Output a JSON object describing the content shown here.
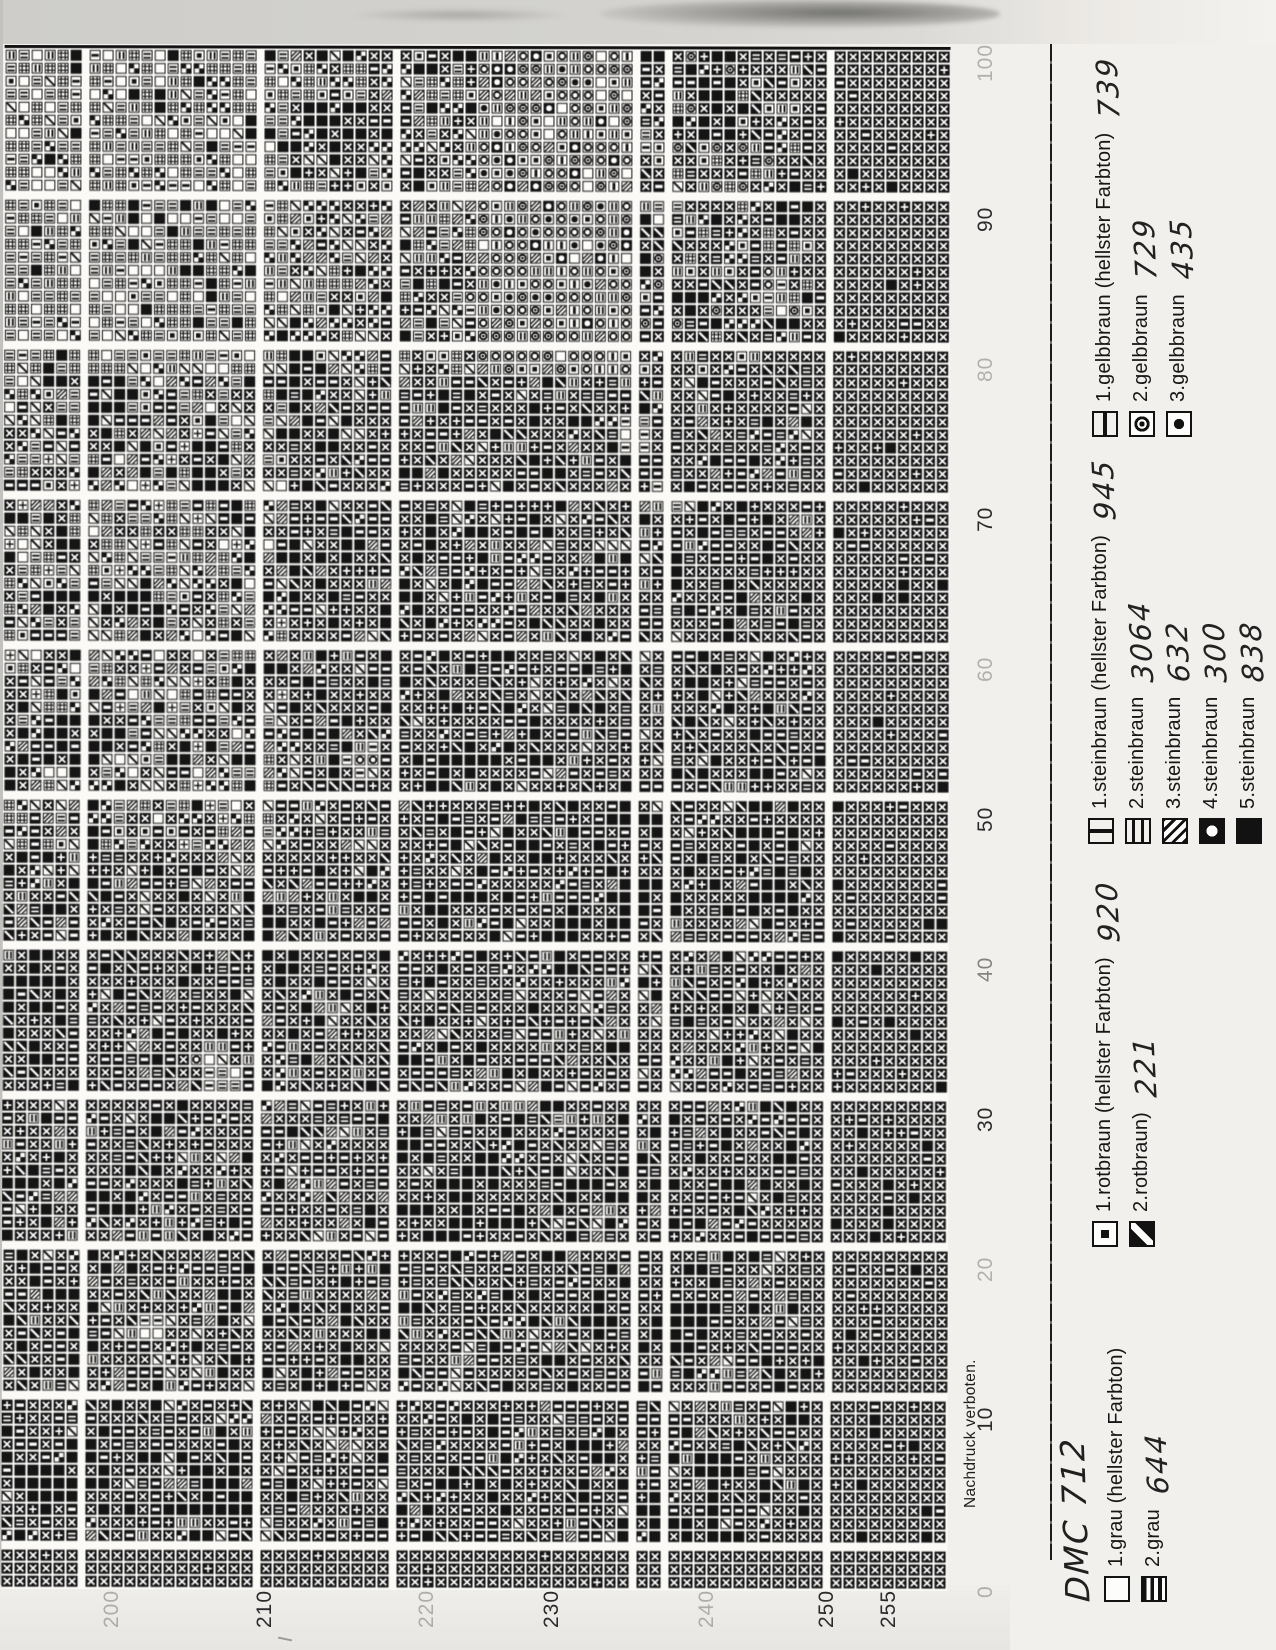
{
  "page": {
    "footer_note": "Nachdruck verboten.",
    "colors": {
      "paper": "#f1f0ec",
      "grid_paper": "#fbfaf6",
      "ink": "#151515",
      "scan_gray": "#d4d3cf"
    }
  },
  "legend": {
    "groups": [
      {
        "name": "grau",
        "heading": "DMC",
        "heading_code": "712",
        "entries": [
          {
            "symbol": "square-empty",
            "label": "1.grau (hellster Farbton)",
            "code": ""
          },
          {
            "symbol": "square-hstripes",
            "label": "2.grau",
            "code": "644"
          }
        ]
      },
      {
        "name": "rotbraun",
        "heading": "",
        "heading_code": "",
        "entries": [
          {
            "symbol": "square-center-square",
            "label": "1.rotbraun (hellster Farbton)",
            "code": "920"
          },
          {
            "symbol": "black-white-diagonal",
            "label": "2.rotbraun)",
            "code": "221"
          }
        ]
      },
      {
        "name": "steinbraun",
        "heading": "",
        "heading_code": "",
        "entries": [
          {
            "symbol": "square-vbar",
            "label": "1.steinbraun (hellster Farbton)",
            "code": "945"
          },
          {
            "symbol": "square-two-hlines",
            "label": "2.steinbraun",
            "code": "3064"
          },
          {
            "symbol": "square-diagonal-hatch",
            "label": "3.steinbraun",
            "code": "632"
          },
          {
            "symbol": "black-white-circle",
            "label": "4.steinbraun",
            "code": "300"
          },
          {
            "symbol": "square-solid",
            "label": "5.steinbraun",
            "code": "838"
          }
        ]
      },
      {
        "name": "gelbbraun",
        "heading": "",
        "heading_code": "",
        "entries": [
          {
            "symbol": "square-hbar",
            "label": "1.gelbbraun (hellster Farbton)",
            "code": "739"
          },
          {
            "symbol": "square-ring-dot",
            "label": "2.gelbbraun",
            "code": "729"
          },
          {
            "symbol": "square-filled-dot",
            "label": "3.gelbbraun",
            "code": "435"
          }
        ]
      }
    ]
  },
  "axes": {
    "right": [
      {
        "t": "100",
        "y": 58,
        "f": "faint"
      },
      {
        "t": "90",
        "y": 208,
        "f": ""
      },
      {
        "t": "80",
        "y": 358,
        "f": "faint"
      },
      {
        "t": "70",
        "y": 508,
        "f": ""
      },
      {
        "t": "60",
        "y": 658,
        "f": "faint"
      },
      {
        "t": "50",
        "y": 808,
        "f": ""
      },
      {
        "t": "40",
        "y": 958,
        "f": "semi"
      },
      {
        "t": "30",
        "y": 1108,
        "f": ""
      },
      {
        "t": "20",
        "y": 1258,
        "f": "faint"
      },
      {
        "t": "10",
        "y": 1408,
        "f": ""
      },
      {
        "t": "0",
        "y": 1574,
        "f": "faint"
      }
    ],
    "bottom": [
      {
        "t": "200",
        "x": 100,
        "f": "faint"
      },
      {
        "t": "210",
        "x": 253,
        "f": ""
      },
      {
        "t": "220",
        "x": 415,
        "f": "faint"
      },
      {
        "t": "230",
        "x": 540,
        "f": ""
      },
      {
        "t": "240",
        "x": 695,
        "f": "faint"
      },
      {
        "t": "250",
        "x": 815,
        "f": ""
      },
      {
        "t": "255",
        "x": 877,
        "f": ""
      }
    ]
  },
  "grid": {
    "cell": 13,
    "gap_x": 6,
    "gap_y": 7,
    "seed": 47.13,
    "column_blocks": [
      6,
      13,
      10,
      18,
      2,
      12,
      9
    ],
    "row_bands": [
      11,
      11,
      11,
      11,
      11,
      11,
      11,
      11,
      11,
      11,
      3
    ],
    "blob_hi": 0.73,
    "blob_lo": 0.17,
    "blob_hi_weights": {
      "solid": 0.6,
      "xblack": 0.25,
      "hbarblack": 0.15
    },
    "blob_lo_weights": {
      "hbar": 0.2,
      "empty": 0.18,
      "vlines2": 0.18,
      "hlines2": 0.16,
      "ring": 0.12,
      "diag": 0.16
    },
    "zones": [
      {
        "name": "bottom-band",
        "x0": 0,
        "x1": 1.01,
        "y0": 0.966,
        "y1": 1.01,
        "blobs": false,
        "w": {
          "xblack": 0.94,
          "plusblack": 0.06
        }
      },
      {
        "name": "right-band",
        "x0": 0.85,
        "x1": 1.01,
        "y0": 0,
        "y1": 1.01,
        "blobs": false,
        "w": {
          "xblack": 0.87,
          "plusblack": 0.05,
          "hbarblack": 0.04,
          "solid": 0.04
        }
      },
      {
        "name": "top-left-light",
        "x0": 0,
        "x1": 0.3,
        "y0": 0,
        "y1": 0.21,
        "blobs": false,
        "w": {
          "crosshatch": 0.26,
          "hlines2": 0.22,
          "empty": 0.12,
          "vlines2": 0.07,
          "checker": 0.09,
          "solid": 0.06,
          "hbar": 0.08,
          "diag": 0.06,
          "dotsq": 0.04
        }
      },
      {
        "name": "top-rings",
        "x0": 0.5,
        "x1": 0.67,
        "y0": 0,
        "y1": 0.21,
        "blobs": false,
        "w": {
          "ring": 0.26,
          "ringdot": 0.17,
          "dotsq": 0.1,
          "vlines2": 0.13,
          "empty": 0.08,
          "dotfill": 0.08,
          "diaghatch": 0.07,
          "vbar": 0.06,
          "circleblack": 0.05
        }
      },
      {
        "name": "top-mid",
        "x0": 0.3,
        "x1": 0.5,
        "y0": 0,
        "y1": 0.21,
        "blobs": true,
        "w": {
          "checker": 0.16,
          "diag": 0.13,
          "xblack": 0.16,
          "crosshatch": 0.1,
          "hbarblack": 0.08,
          "solid": 0.07,
          "dotsq": 0.06,
          "vlines2": 0.06,
          "diaghatch": 0.07,
          "hlines2": 0.06,
          "plusblack": 0.05
        }
      },
      {
        "name": "top-right",
        "x0": 0.67,
        "x1": 0.85,
        "y0": 0,
        "y1": 0.21,
        "blobs": true,
        "w": {
          "xblack": 0.3,
          "checker": 0.09,
          "hbarblack": 0.12,
          "plusblack": 0.08,
          "solid": 0.08,
          "hlinesblack": 0.06,
          "diagblack": 0.06,
          "vlines2": 0.05,
          "crosshatch": 0.06,
          "ringdot": 0.04,
          "dotsq": 0.06
        }
      },
      {
        "name": "mid-left",
        "x0": 0,
        "x1": 0.3,
        "y0": 0.21,
        "y1": 0.52,
        "blobs": true,
        "w": {
          "checker": 0.14,
          "diag": 0.13,
          "crosshatch": 0.11,
          "hlines2": 0.09,
          "xblack": 0.15,
          "hbarblack": 0.1,
          "solid": 0.08,
          "plus": 0.04,
          "dotsq": 0.04,
          "diaghatch": 0.07,
          "empty": 0.05
        }
      },
      {
        "name": "dark-default",
        "x0": 0,
        "x1": 1.01,
        "y0": 0,
        "y1": 1.01,
        "blobs": true,
        "w": {
          "xblack": 0.34,
          "hbarblack": 0.16,
          "solid": 0.11,
          "plusblack": 0.09,
          "hlinesblack": 0.06,
          "diagblack": 0.06,
          "diag": 0.05,
          "checker": 0.05,
          "vlines2": 0.04,
          "diaghatch": 0.04
        }
      }
    ]
  }
}
